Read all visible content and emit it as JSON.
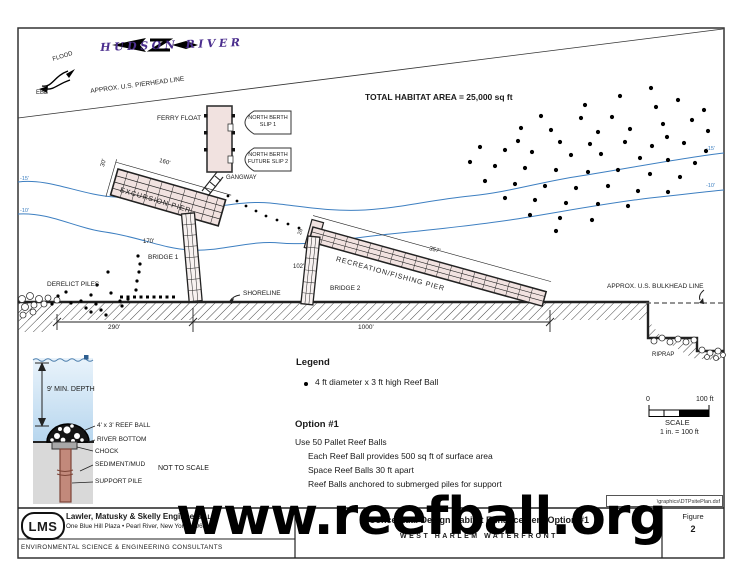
{
  "map": {
    "river_label": "HUDSON RIVER",
    "flood": "FLOOD",
    "ebb": "EBB",
    "pierhead_line": "APPROX. U.S. PIERHEAD LINE",
    "bulkhead_line": "APPROX. U.S. BULKHEAD LINE",
    "habitat_note": "TOTAL HABITAT AREA = 25,000 sq ft",
    "ferry_float": "FERRY FLOAT",
    "berth1_line1": "NORTH BERTH",
    "berth1_line2": "SLIP 1",
    "berth2_line1": "NORTH BERTH",
    "berth2_line2": "FUTURE SLIP 2",
    "gangway": "GANGWAY",
    "excursion_pier": "EXCURSION PIER",
    "recreation_pier": "RECREATION/FISHING PIER",
    "bridge1": "BRIDGE 1",
    "bridge2": "BRIDGE 2",
    "derelict_piles": "DERELICT PILES",
    "shoreline": "SHORELINE",
    "riprap": "RIPRAP",
    "dims": {
      "pier_length": "160'",
      "pier_width": "30'",
      "bridge1_length": "170'",
      "shore_left": "290'",
      "shore_right": "1000'",
      "rec_pier_width": "26'",
      "bridge2_length": "102'",
      "rec_pier_length": "357'"
    },
    "contours": {
      "c15": "-15'",
      "c10": "-10'"
    }
  },
  "detail": {
    "min_depth": "9' MIN. DEPTH",
    "reef_ball": "4' x 3' REEF BALL",
    "river_bottom": "RIVER BOTTOM",
    "chock": "CHOCK",
    "sediment": "SEDIMENT/MUD",
    "support_pile": "SUPPORT PILE",
    "not_to_scale": "NOT TO SCALE"
  },
  "legend": {
    "title": "Legend",
    "bullet": "•",
    "item": "4 ft diameter x 3 ft high Reef Ball"
  },
  "option": {
    "title": "Option #1",
    "line1": "Use 50 Pallet Reef Balls",
    "line2": "Each Reef Ball provides 500 sq ft of surface area",
    "line3": "Space Reef Balls 30 ft apart",
    "line4": "Reef Balls anchored to submerged piles for support"
  },
  "scale": {
    "zero": "0",
    "hundred": "100 ft",
    "label": "SCALE",
    "ratio": "1 in. = 100 ft"
  },
  "titleblock": {
    "logo": "LMS",
    "company": "Lawler, Matusky & Skelly Engineers",
    "company_suffix": "LLP",
    "address": "One Blue Hill Plaza • Pearl River, New York 10965",
    "consultants": "ENVIRONMENTAL SCIENCE & ENGINEERING CONSULTANTS",
    "sheet_title": "Conceptual Design Habitat Enhancement Option #1",
    "subtitle": "WEST HARLEM WATERFRONT",
    "figure_label": "Figure",
    "figure_number": "2",
    "file_path": "\\graphics\\DTPsitePlan.dsf"
  },
  "watermark": "www.reefball.org",
  "colors": {
    "contour_blue": "#3d7fc1",
    "river_purple": "#4b2e8e",
    "pier_fill": "#f1e2e0",
    "water_fill": "#c9dff2",
    "sediment_fill": "#d9d9d9",
    "pile_fill": "#c2897b"
  }
}
